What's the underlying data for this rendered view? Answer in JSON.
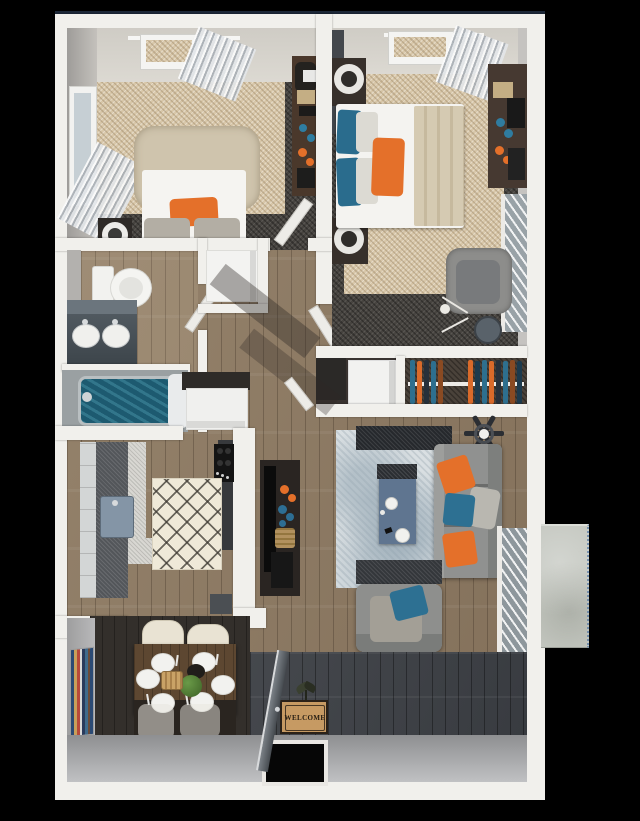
{
  "scene": {
    "type": "3d-floor-plan-render",
    "description": "Top-down 3D rendering of a two-bedroom, one-bath apartment with balcony",
    "background_color": "#000000",
    "image_width": 640,
    "image_height": 821
  },
  "entry": {
    "welcome_mat_text": "WELCOME"
  },
  "rooms": [
    {
      "name": "bedroom-1",
      "furniture": [
        "upholstered bed with orange, gray and blue pillows",
        "nightstand with round lamp",
        "desk with chair, books, blue and orange decor",
        "window with curtain",
        "window with blinds"
      ]
    },
    {
      "name": "bedroom-2",
      "furniture": [
        "bed with blue, gray and orange pillows and beige throw",
        "two nightstands with round lamps",
        "dresser with books and decor",
        "gray armchair",
        "round side table",
        "floor lamp",
        "window with curtain",
        "window with blinds"
      ]
    },
    {
      "name": "bathroom",
      "furniture": [
        "toilet",
        "double-sink vanity",
        "soaking tub with teal water"
      ]
    },
    {
      "name": "linen-closet",
      "furniture": [
        "white storage unit"
      ]
    },
    {
      "name": "hallway",
      "furniture": [
        "open white doors"
      ]
    },
    {
      "name": "storage-closet",
      "furniture": [
        "white appliance box",
        "dark cabinet"
      ]
    },
    {
      "name": "walk-in-closet",
      "furniture": [
        "hanging rod with orange, blue and navy clothes"
      ]
    },
    {
      "name": "kitchen",
      "furniture": [
        "refrigerator",
        "light cabinet run",
        "dark granite counter",
        "sink",
        "black stove",
        "diamond-lattice rug"
      ]
    },
    {
      "name": "living-room",
      "furniture": [
        "gray sofa with orange and blue pillows",
        "gray armchair with blue pillow",
        "slate-blue coffee table with cups",
        "granite console tables",
        "tv console with decor",
        "ceiling fan",
        "mottled area rug",
        "sliding glass door with blinds"
      ]
    },
    {
      "name": "dining-area",
      "furniture": [
        "dark wood table",
        "four cream chairs",
        "six place settings",
        "green centerpiece plant",
        "bread basket",
        "striped wall art"
      ]
    },
    {
      "name": "entry",
      "furniture": [
        "open front door",
        "welcome mat",
        "small floor plant"
      ]
    },
    {
      "name": "balcony",
      "furniture": [
        "concrete patio slab"
      ]
    }
  ],
  "colors": {
    "accent_orange": "#e4702a",
    "accent_blue": "#2d7092",
    "carpet_beige": "#d8c7a9",
    "carpet_dark": "#474440",
    "wood_light": "#8f7d66",
    "wood_dark": "#3f4246",
    "wall_white": "#f1f0ec",
    "wall_gray_face": "#a9a9ab",
    "living_rug": "#d9dfe2",
    "kitchen_rug": "#efe9d8",
    "coffee_table_blue": "#5f7590",
    "tub_water_teal": "#1d5a70",
    "concrete_slab": "#c4c7c0",
    "mat_tan": "#c69a63",
    "console_brown": "#2a2522"
  }
}
